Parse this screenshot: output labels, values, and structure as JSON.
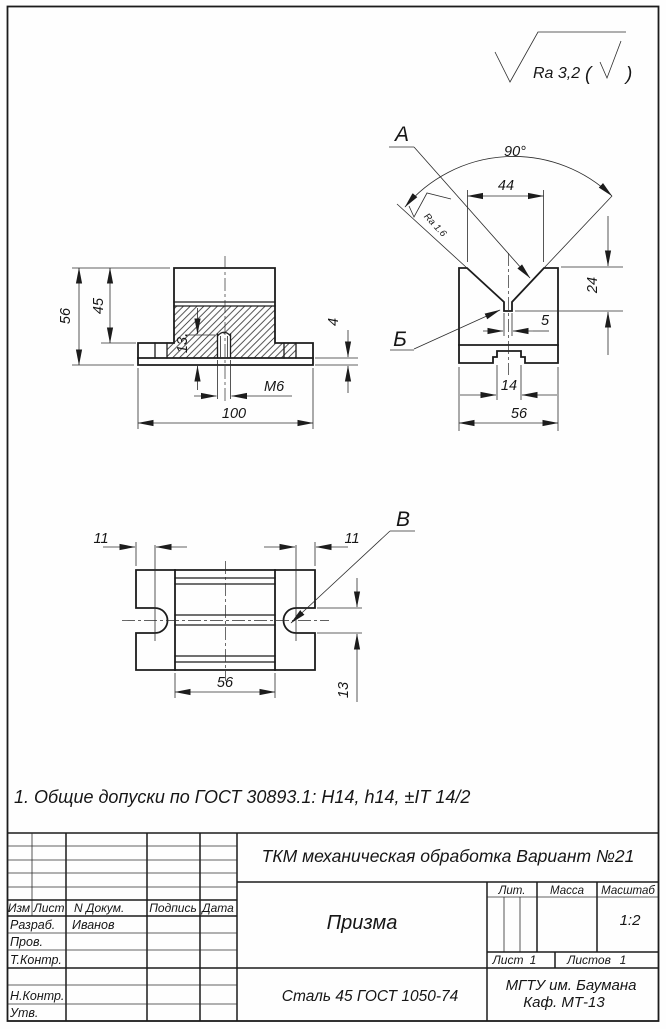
{
  "roughness": {
    "general": "Ra 3,2",
    "open": "(",
    "close": ")"
  },
  "note": "1. Общие допуски по ГОСТ 30893.1:  H14, h14, ±IT 14/2",
  "front_view": {
    "height": "56",
    "body_height": "45",
    "hole_depth": "13.",
    "base_thickness": "4",
    "thread": "M6",
    "width": "100"
  },
  "side_view": {
    "view_label": "А",
    "detail_label": "Б",
    "angle": "90°",
    "v_width": "44",
    "v_depth": "24",
    "groove_width": "5",
    "slot_width": "14",
    "width": "56",
    "v_roughness": "Ra 1.6"
  },
  "top_view": {
    "detail_label": "В",
    "slot_depth_left": "11",
    "slot_depth_right": "11",
    "width": "56",
    "slot_width": "13"
  },
  "title_block": {
    "project_title": "ТКМ механическая обработка Вариант №21",
    "part_name": "Призма",
    "material": "Сталь 45 ГОСТ 1050-74",
    "organization": "МГТУ им. Баумана",
    "department": "Каф. МТ-13",
    "col_izm": "Изм",
    "col_list": "Лист",
    "col_doc": "N Докум.",
    "col_sign": "Подпись",
    "col_date": "Дата",
    "row_developed": "Разраб.",
    "row_checked": "Пров.",
    "row_tcontrol": "Т.Контр.",
    "row_ncontrol": "Н.Контр.",
    "row_approved": "Утв.",
    "developer_name": "Иванов",
    "lit_label": "Лит.",
    "mass_label": "Масса",
    "scale_label": "Масштаб",
    "scale_value": "1:2",
    "sheet_label": "Лист",
    "sheet_value": "1",
    "sheets_label": "Листов",
    "sheets_value": "1"
  }
}
